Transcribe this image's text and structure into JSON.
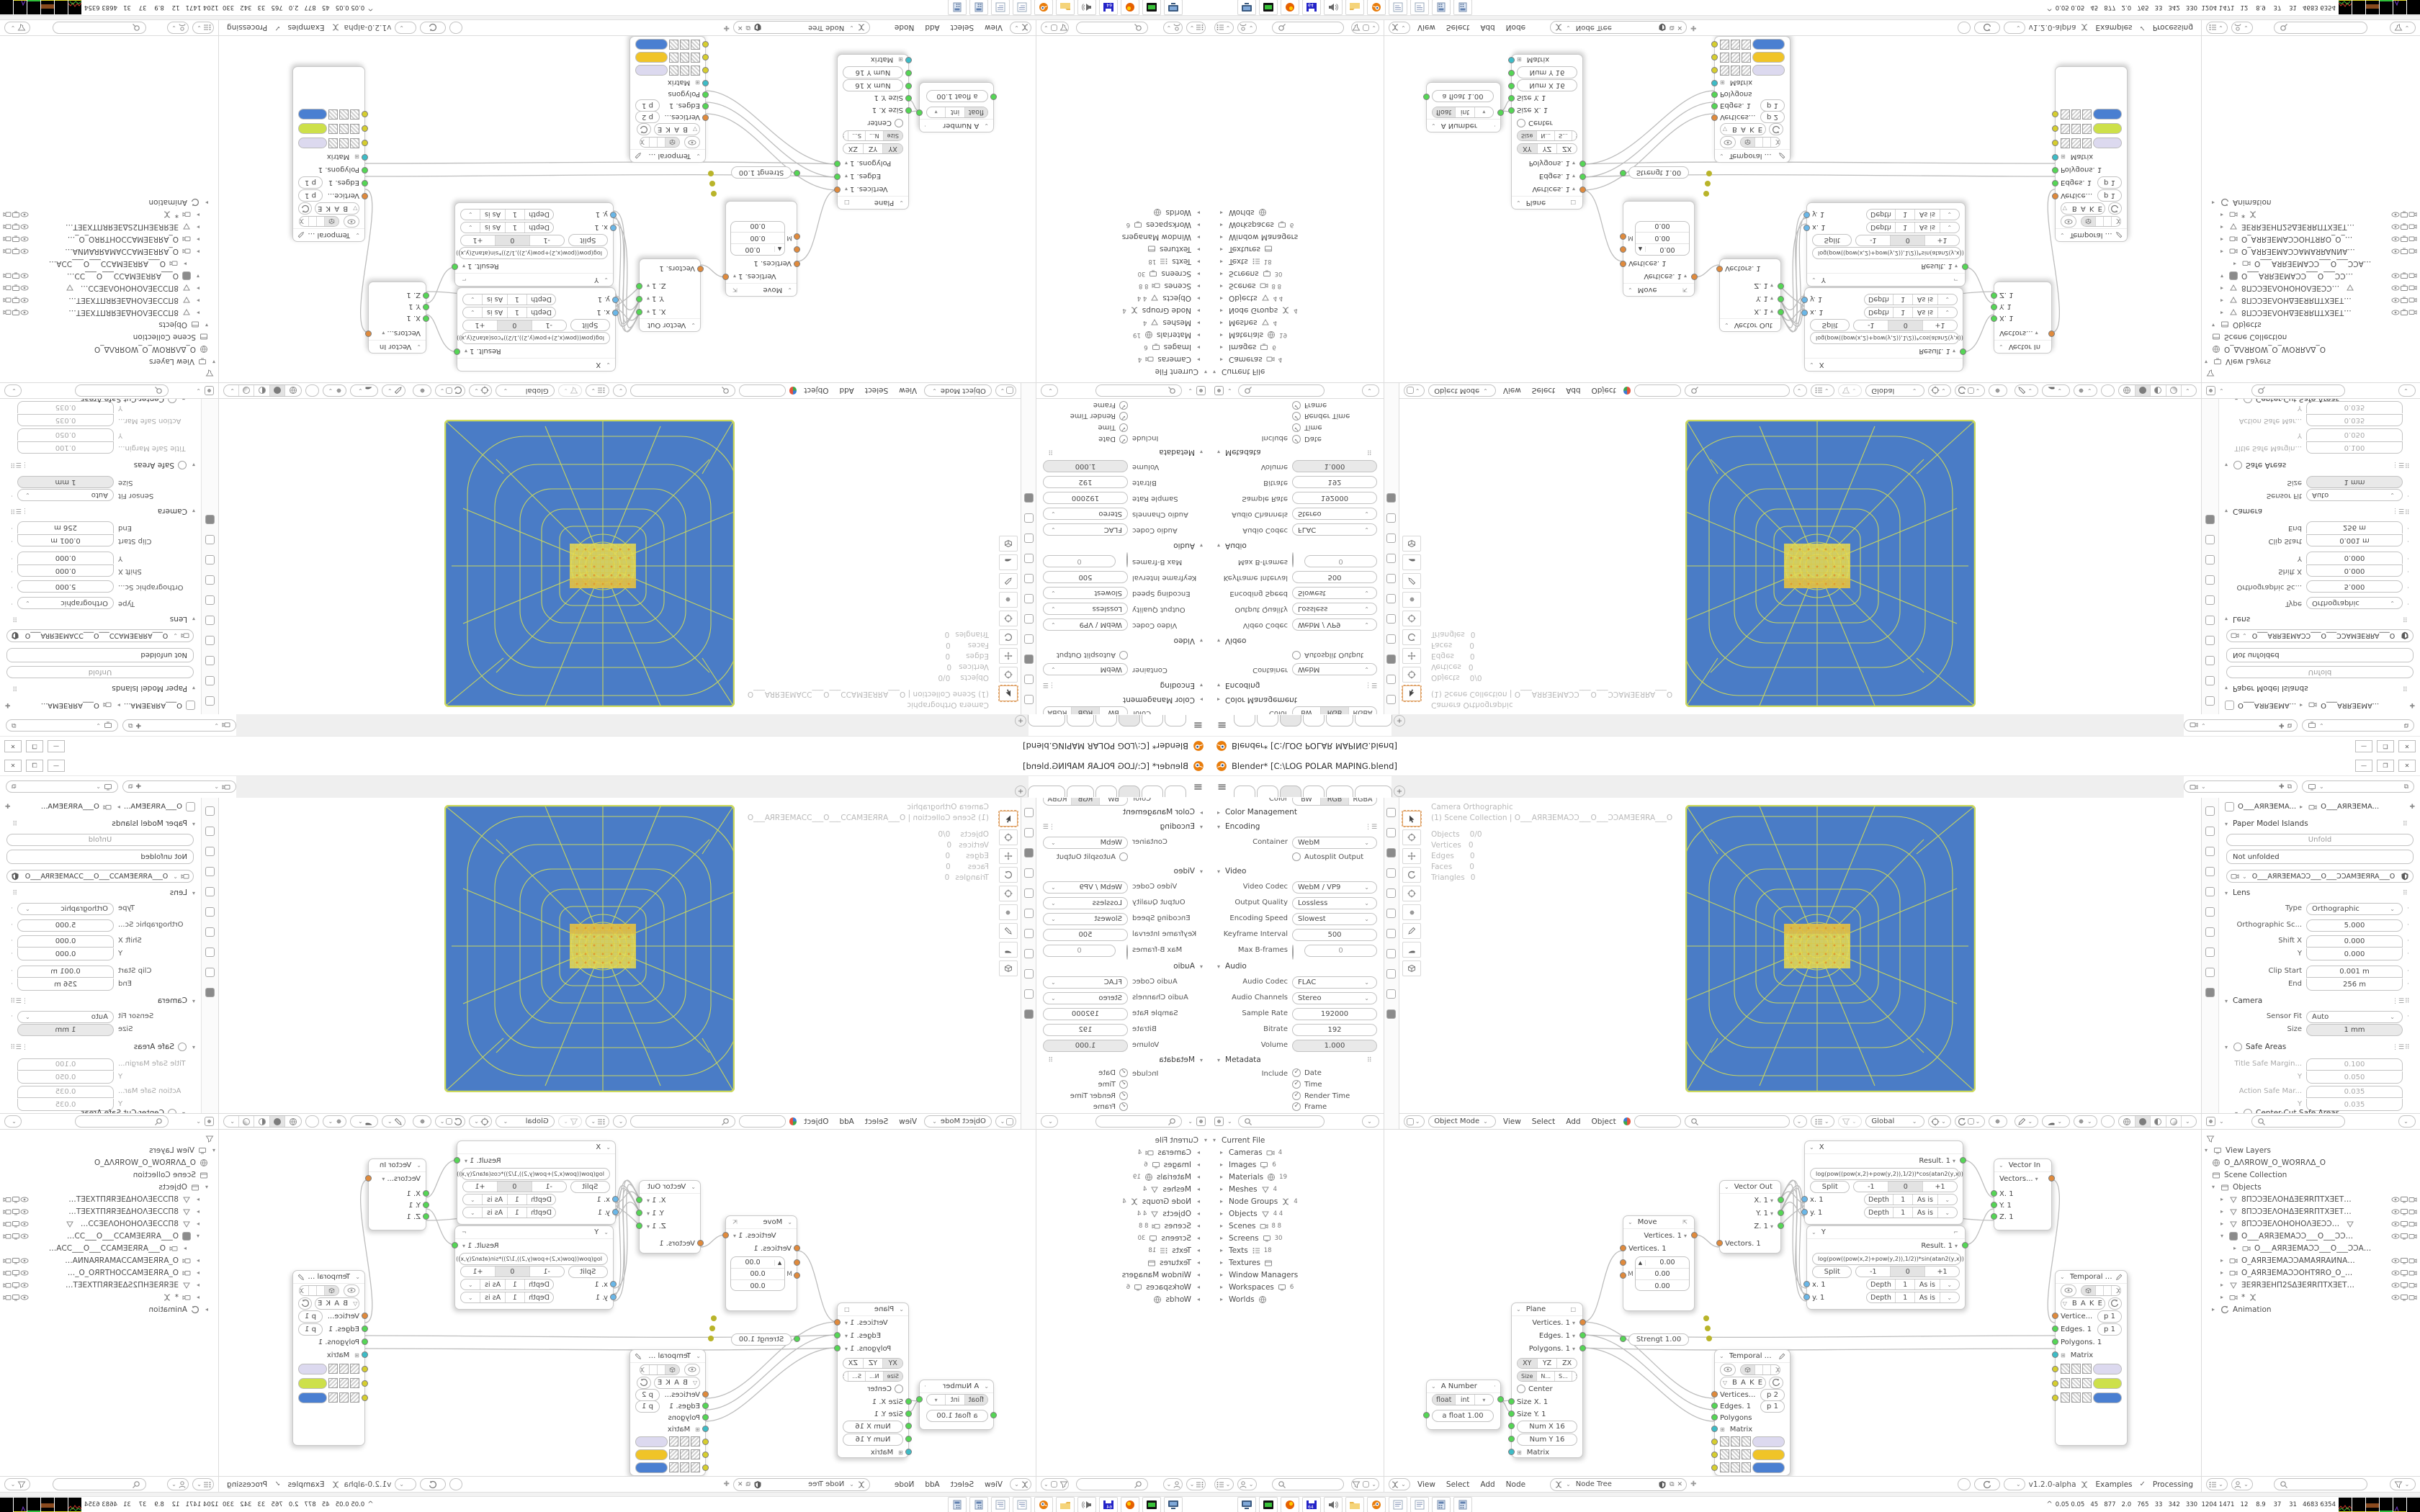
{
  "window": {
    "title": "Blender* [C:\\LOG POLAR MAPING.blend]",
    "minimize": "—",
    "maximize": "❐",
    "close": "✕"
  },
  "icons": {
    "hamburger": "≡",
    "plus": "+",
    "caret": "∨",
    "caret_small": "⌄",
    "tri_down": "▾",
    "tri_right": "▸",
    "check": "✓",
    "close": "✕",
    "dots_grid": "⠿",
    "list": "⋮☰",
    "pin": "✚",
    "copy": "⧉",
    "chevron_up": "^",
    "spin_up": "▲",
    "bake_tri": "▽",
    "square": "□",
    "matrix": "⊞",
    "dot": "·"
  },
  "topbar": {
    "scene_field": "",
    "view_layer_field": ""
  },
  "output_props": {
    "color_label": "Color",
    "color_modes": [
      "BW",
      "RGB",
      "RGBA"
    ],
    "color_management": "Color Management",
    "encoding": "Encoding",
    "container_label": "Container",
    "container": "WebM",
    "autosplit": "Autosplit Output",
    "video": "Video",
    "video_codec_label": "Video Codec",
    "video_codec": "WebM / VP9",
    "output_quality_label": "Output Quality",
    "output_quality": "Lossless",
    "encoding_speed_label": "Encoding Speed",
    "encoding_speed": "Slowest",
    "keyframe_label": "Keyframe Interval",
    "keyframe": "500",
    "max_b_label": "Max B-frames",
    "max_b": "0",
    "audio": "Audio",
    "audio_codec_label": "Audio Codec",
    "audio_codec": "FLAC",
    "audio_channels_label": "Audio Channels",
    "audio_channels": "Stereo",
    "sample_rate_label": "Sample Rate",
    "sample_rate": "192000",
    "bitrate_label": "Bitrate",
    "bitrate": "192",
    "volume_label": "Volume",
    "volume": "1.000",
    "metadata": "Metadata",
    "include_label": "Include",
    "include_items": [
      "Date",
      "Time",
      "Render Time",
      "Frame",
      "Frame Range"
    ]
  },
  "viewport": {
    "mode": "Object Mode",
    "menus": [
      "View",
      "Select",
      "Add",
      "Object"
    ],
    "orientation": "Global",
    "overlay_line1": "Camera Orthographic",
    "overlay_line2": "(1) Scene Collection | O___AЯRƎEMAƆƆ___O___ƆƆAMƎEЯRA___O",
    "stats": [
      {
        "k": "Objects",
        "v": "0/0"
      },
      {
        "k": "Vertices",
        "v": "0"
      },
      {
        "k": "Edges",
        "v": "0"
      },
      {
        "k": "Faces",
        "v": "0"
      },
      {
        "k": "Triangles",
        "v": "0"
      }
    ]
  },
  "camera_props": {
    "breadcrumb_object": "O___AЯRƎEMA...",
    "breadcrumb_data": "O___AЯRƎEMA...",
    "paper_model_title": "Paper Model Islands",
    "unfold": "Unfold",
    "unfold_status": "Not unfolded",
    "datablock": "O___AЯRƎEMAƆƆ___O___ƆƆAMƎEЯRA___O",
    "lens_title": "Lens",
    "type_label": "Type",
    "type": "Orthographic",
    "ortho_label": "Orthographic Sc...",
    "ortho": "5.000",
    "shift_x_label": "Shift X",
    "shift_x": "0.000",
    "shift_y_label": "Y",
    "shift_y": "0.000",
    "clip_start_label": "Clip Start",
    "clip_start": "0.001 m",
    "clip_end_label": "End",
    "clip_end": "256 m",
    "camera_title": "Camera",
    "sensor_fit_label": "Sensor Fit",
    "sensor_fit": "Auto",
    "size_label": "Size",
    "size": "1 mm",
    "safe_areas_title": "Safe Areas",
    "safe_rows": [
      {
        "k": "Title Safe Margin...",
        "v": "0.100"
      },
      {
        "k": "Y",
        "v": "0.050"
      },
      {
        "k": "Action Safe Mar...",
        "v": "0.035"
      },
      {
        "k": "Y",
        "v": "0.035"
      }
    ],
    "center_cut": "Center-Cut Safe Areas"
  },
  "file_outliner": {
    "rows": [
      {
        "label": "Current File",
        "count": ""
      },
      {
        "label": "Cameras",
        "count": "4"
      },
      {
        "label": "Images",
        "count": "6"
      },
      {
        "label": "Materials",
        "count": "19"
      },
      {
        "label": "Meshes",
        "count": "4"
      },
      {
        "label": "Node Groups",
        "count": "4"
      },
      {
        "label": "Objects",
        "count": "4  4"
      },
      {
        "label": "Scenes",
        "count": "8  8"
      },
      {
        "label": "Screens",
        "count": "30"
      },
      {
        "label": "Texts",
        "count": "18"
      },
      {
        "label": "Textures",
        "count": ""
      },
      {
        "label": "Window Managers",
        "count": ""
      },
      {
        "label": "Workspaces",
        "count": "6"
      },
      {
        "label": "Worlds",
        "count": ""
      }
    ]
  },
  "node_editor": {
    "menus": [
      "View",
      "Select",
      "Add",
      "Node"
    ],
    "tree_name": "Node Tree",
    "version": "v1.2.0-alpha",
    "examples": "Examples",
    "processing": "Processing",
    "nodes": {
      "a_number": {
        "title": "A Number",
        "opt_float": "float",
        "opt_int": "int",
        "value_row": "a float      1.00"
      },
      "plane": {
        "title": "Plane",
        "out1": "Vertices. 1",
        "out2": "Edges. 1",
        "out3": "Polygons. 1",
        "ax": [
          "XY",
          "YZ",
          "ZX"
        ],
        "sz": [
          "Size",
          "N...",
          "S...",
          "Si..."
        ],
        "center": "Center",
        "in1": "Size X. 1",
        "in2": "Size Y. 1",
        "numx": "Num X      16",
        "numy": "Num Y      16",
        "matrix": "Matrix"
      },
      "move": {
        "title": "Move",
        "out": "Vertices. 1",
        "in": "Vertices. 1",
        "v1": "0.00",
        "v2": "0.00",
        "v3": "0.00",
        "m": "M",
        "strength": "Strengt   1.00"
      },
      "vector_out": {
        "title": "Vector Out",
        "x": "X. 1",
        "y": "Y. 1",
        "z": "Z. 1",
        "in": "Vectors. 1"
      },
      "formula_x": {
        "title": "X",
        "result": "Result. 1",
        "formula": "log(pow((pow(x,2)+pow(y,2)),1/2))*cos(atan2(y,x))",
        "split": "Split",
        "seg": [
          "-1",
          "0",
          "+1"
        ],
        "r1": "x. 1",
        "r2": "y. 1",
        "depth": "Depth",
        "one": "1",
        "asis": "As is"
      },
      "formula_y": {
        "title": "Y",
        "result": "Result. 1",
        "formula": "log(pow((pow(x,2)+pow(y,2)),1/2))*sin(atan2(y,x))",
        "split": "Split",
        "seg": [
          "-1",
          "0",
          "+1"
        ],
        "r1": "x. 1",
        "r2": "y. 1",
        "depth": "Depth",
        "one": "1",
        "asis": "As is"
      },
      "vector_in": {
        "title": "Vector In",
        "out": "Vectors...",
        "x": "X. 1",
        "y": "Y. 1",
        "z": "Z. 1"
      },
      "viewer1": {
        "title": "Temporal Viewer",
        "bake": "B A K E",
        "in1": "Vertice...",
        "p1": "p   1",
        "in2": "Edges. 1",
        "p2": "p   1",
        "in3": "Polygons. 1",
        "matrix": "Matrix"
      },
      "viewer2": {
        "title": "Temporal Viewer",
        "bake": "B A K E",
        "in1": "Vertices...",
        "p1": "p   2",
        "in2": "Edges. 1",
        "p2": "p   1",
        "in3": "Polygons",
        "matrix": "Matrix"
      }
    }
  },
  "view_outliner": {
    "title": "View Layers",
    "world": "O_ΔΛЯROW_O_WOЯRΛΔ_O",
    "scene_collection": "Scene Collection",
    "objects_label": "Objects",
    "rows": [
      "8ΠƆƆƎEΛOHΔƎEЯRΠTXƎETOTƎEXTΠЯ8",
      "8ΠƆƆƎEΛOHΔƎEЯRΠTXƎETOTƎEXTΠЯ8",
      "8ΠƆƆƎEΛOHOHOΛƎEƆƆΠ8",
      "O___AЯRƎEMAƆƆ___O___ƆƆAMƎEЯRA",
      "O___AЯRƎEMAƆƆ___O___ƆƆAMƎE",
      "O_AЯRƎEMAƆƆAMAЯRAИNAΠ__O_ΠA",
      "O_AЯRƎEMAƆƆOHTЯRO_O_OЯRTHƆƆƆ",
      "ƎEЯRƎEHΠ2SΔƎEЯRΠTXƎETOTƎEXTΠЯ",
      "*"
    ],
    "animation": "Animation"
  },
  "taskbar": {
    "expand": "^",
    "stats": "0.05 0.05   45   877   2.0   765   33   342   330  1204 1471   12    8.9    37    31   4683 6354",
    "apps": [
      "screen-capture",
      "recorder",
      "firefox",
      "floppy-64",
      "volume",
      "folder",
      "blender",
      "notepad",
      "notepad",
      "calculator",
      "calculator"
    ]
  },
  "colors": {
    "object_blue": "#4a7cc6",
    "wire_yellow": "#ccd95c",
    "select_orange": "#e09b30",
    "viewer_vertex": "#dcd9ef",
    "viewer_edge_amber": "#f0c428",
    "viewer_edge_lime": "#cde04a",
    "viewer_face_blue": "#4a7fd1"
  }
}
